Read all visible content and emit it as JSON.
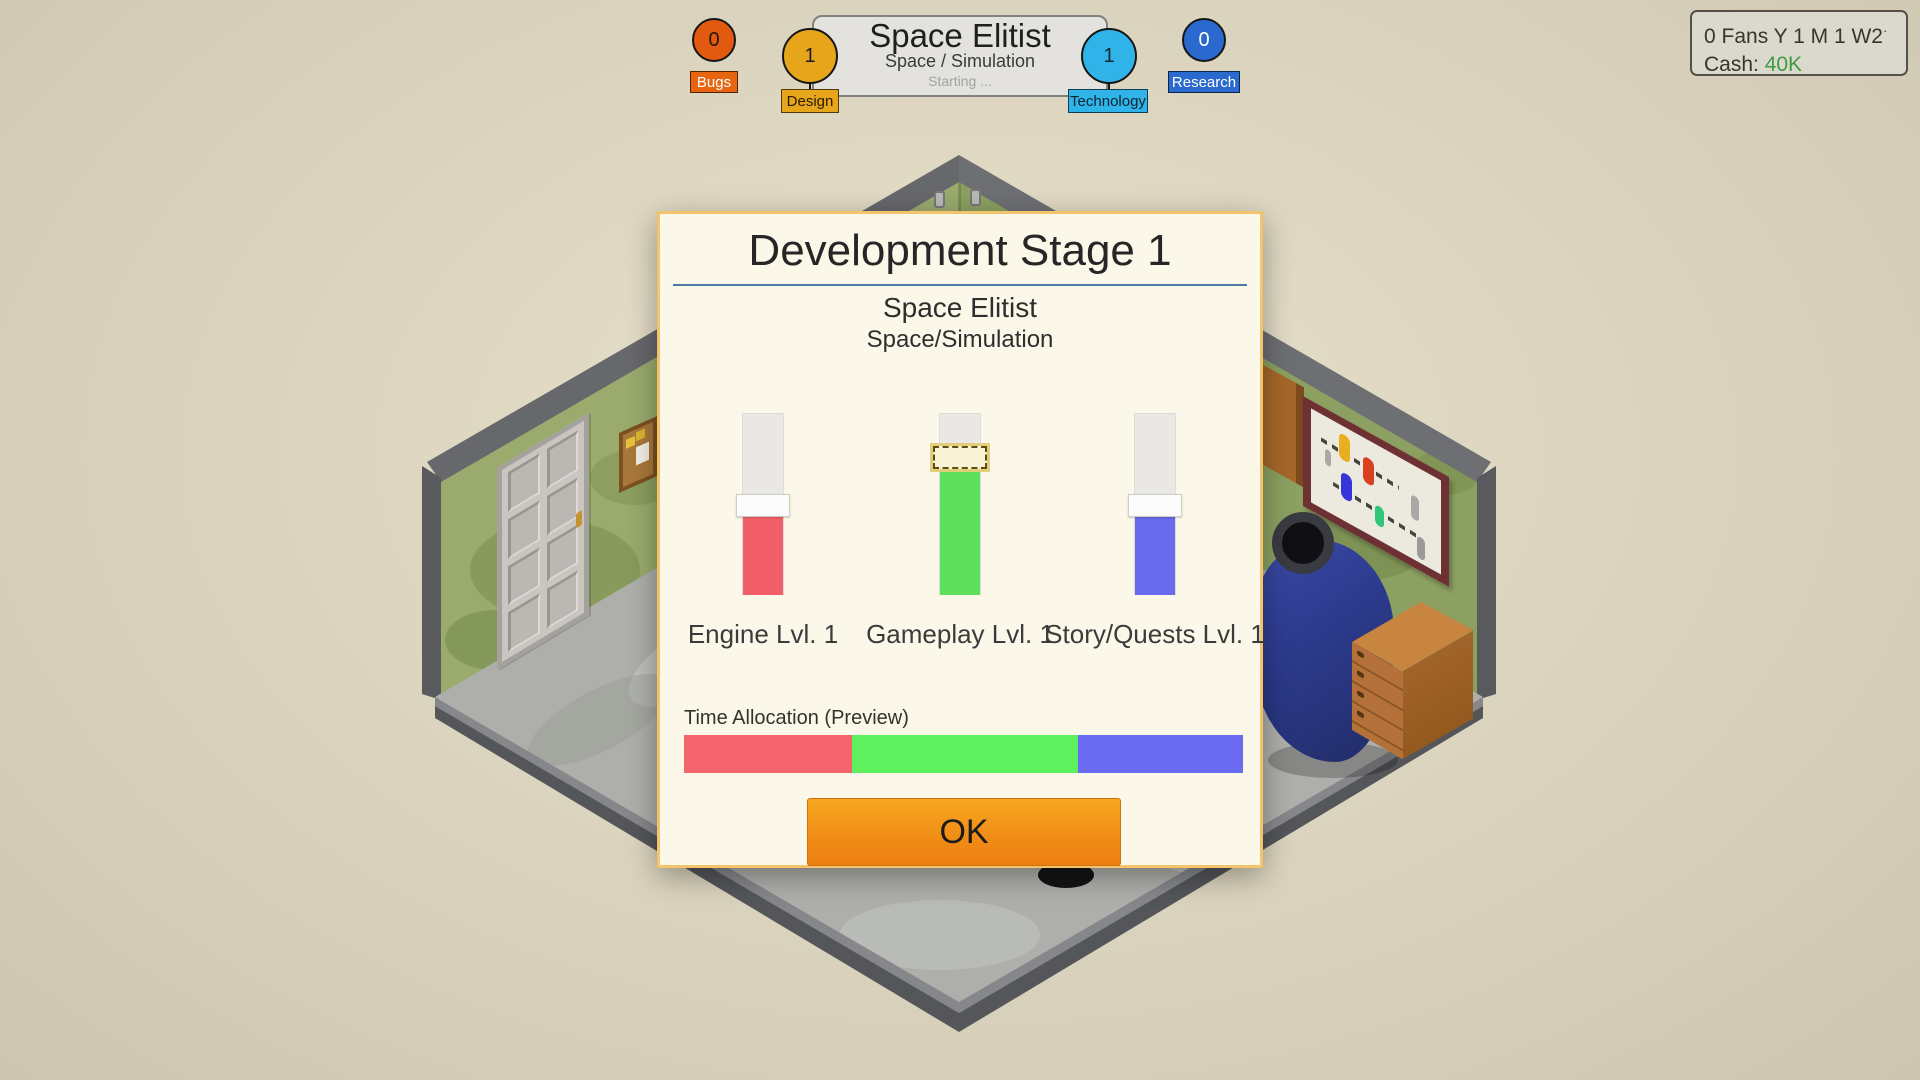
{
  "header": {
    "stats": [
      {
        "id": "bugs",
        "value": "0",
        "label": "Bugs",
        "circle_color": "#e25a10",
        "number_color": "#2a1505",
        "label_bg": "#e8650f",
        "label_text": "#ffffff"
      },
      {
        "id": "design",
        "value": "1",
        "label": "Design",
        "circle_color": "#e6a51a",
        "number_color": "#1c1c1c",
        "label_bg": "#e6a51a",
        "label_text": "#2a1c05"
      },
      {
        "id": "technology",
        "value": "1",
        "label": "Technology",
        "circle_color": "#2fb3e8",
        "number_color": "#10262e",
        "label_bg": "#2fb3e8",
        "label_text": "#0e2630"
      },
      {
        "id": "research",
        "value": "0",
        "label": "Research",
        "circle_color": "#2a6ace",
        "number_color": "#ffffff",
        "label_bg": "#2a6ace",
        "label_text": "#ffffff"
      }
    ],
    "game_card": {
      "title": "Space Elitist",
      "genre": "Space / Simulation",
      "status": "Starting ..."
    },
    "info_box": {
      "fans_line": "0 Fans Y 1 M 1 W2",
      "fans_tick": "·",
      "cash_label": "Cash:",
      "cash_value": "40K",
      "cash_color": "#3f9b42"
    }
  },
  "dialog": {
    "title": "Development Stage 1",
    "game_title": "Space Elitist",
    "game_genre": "Space/Simulation",
    "sliders": [
      {
        "label": "Engine Lvl. 1",
        "fill_color": "#f25f68",
        "fill_pct": 43,
        "handle_top_pct": 44.5,
        "selected": false
      },
      {
        "label": "Gameplay Lvl. 1",
        "fill_color": "#5ee05e",
        "fill_pct": 69,
        "handle_top_pct": 18,
        "selected": true
      },
      {
        "label": "Story/Quests Lvl. 1",
        "fill_color": "#6a6aee",
        "fill_pct": 43,
        "handle_top_pct": 44.5,
        "selected": false
      }
    ],
    "allocation": {
      "label": "Time Allocation (Preview)",
      "segments": [
        {
          "name": "engine",
          "color": "#f4646c",
          "pct": 30
        },
        {
          "name": "gameplay",
          "color": "#5ef05e",
          "pct": 40.5
        },
        {
          "name": "story",
          "color": "#6a6af2",
          "pct": 29.5
        }
      ]
    },
    "ok_label": "OK"
  }
}
